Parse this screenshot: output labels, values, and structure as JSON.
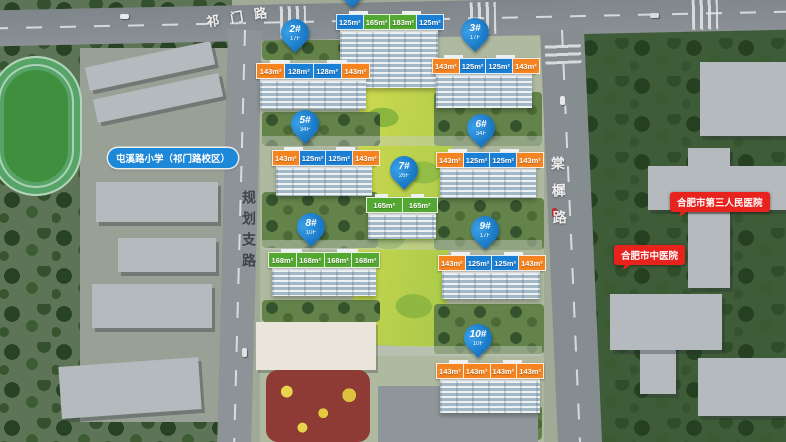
{
  "map": {
    "roads": {
      "top": "祁门路",
      "left": "规划支路",
      "right": "棠樨路"
    },
    "pois": {
      "school": "屯溪路小学（祁门路校区）",
      "hospital_1": "合肥市第三人民医院",
      "hospital_2": "合肥市中医院"
    },
    "buildings": [
      {
        "name": "top-tower",
        "pin": "",
        "floors": "",
        "units": [
          {
            "area": "125m²",
            "type": "blue"
          },
          {
            "area": "165m²",
            "type": "green"
          },
          {
            "area": "183m²",
            "type": "green"
          },
          {
            "area": "125m²",
            "type": "blue"
          }
        ]
      },
      {
        "name": "2",
        "pin": "2#",
        "floors": "17F",
        "units": [
          {
            "area": "143m²",
            "type": "orange"
          },
          {
            "area": "128m²",
            "type": "blue"
          },
          {
            "area": "128m²",
            "type": "blue"
          },
          {
            "area": "143m²",
            "type": "orange"
          }
        ]
      },
      {
        "name": "3",
        "pin": "3#",
        "floors": "17F",
        "units": [
          {
            "area": "143m²",
            "type": "orange"
          },
          {
            "area": "125m²",
            "type": "blue"
          },
          {
            "area": "125m²",
            "type": "blue"
          },
          {
            "area": "143m²",
            "type": "orange"
          }
        ]
      },
      {
        "name": "5",
        "pin": "5#",
        "floors": "34F",
        "units": [
          {
            "area": "143m²",
            "type": "orange"
          },
          {
            "area": "125m²",
            "type": "blue"
          },
          {
            "area": "125m²",
            "type": "blue"
          },
          {
            "area": "143m²",
            "type": "orange"
          }
        ]
      },
      {
        "name": "6",
        "pin": "6#",
        "floors": "34F",
        "units": [
          {
            "area": "143m²",
            "type": "orange"
          },
          {
            "area": "125m²",
            "type": "blue"
          },
          {
            "area": "125m²",
            "type": "blue"
          },
          {
            "area": "143m²",
            "type": "orange"
          }
        ]
      },
      {
        "name": "7",
        "pin": "7#",
        "floors": "26F",
        "units": [
          {
            "area": "165m²",
            "type": "green"
          },
          {
            "area": "165m²",
            "type": "green"
          }
        ]
      },
      {
        "name": "8",
        "pin": "8#",
        "floors": "10F",
        "units": [
          {
            "area": "168m²",
            "type": "green"
          },
          {
            "area": "168m²",
            "type": "green"
          },
          {
            "area": "168m²",
            "type": "green"
          },
          {
            "area": "168m²",
            "type": "green"
          }
        ]
      },
      {
        "name": "9",
        "pin": "9#",
        "floors": "17F",
        "units": [
          {
            "area": "143m²",
            "type": "orange"
          },
          {
            "area": "125m²",
            "type": "blue"
          },
          {
            "area": "125m²",
            "type": "blue"
          },
          {
            "area": "143m²",
            "type": "orange"
          }
        ]
      },
      {
        "name": "10",
        "pin": "10#",
        "floors": "10F",
        "units": [
          {
            "area": "143m²",
            "type": "orange"
          },
          {
            "area": "143m²",
            "type": "orange"
          },
          {
            "area": "143m²",
            "type": "orange"
          },
          {
            "area": "143m²",
            "type": "orange"
          }
        ]
      }
    ],
    "colors": {
      "pin_blue": "#0e74c8",
      "unit_orange": "#f5831f",
      "unit_blue": "#1b7fd4",
      "unit_green": "#52a830",
      "school_pill_blue": "#1e88d8",
      "hospital_red": "#e8231e"
    }
  }
}
